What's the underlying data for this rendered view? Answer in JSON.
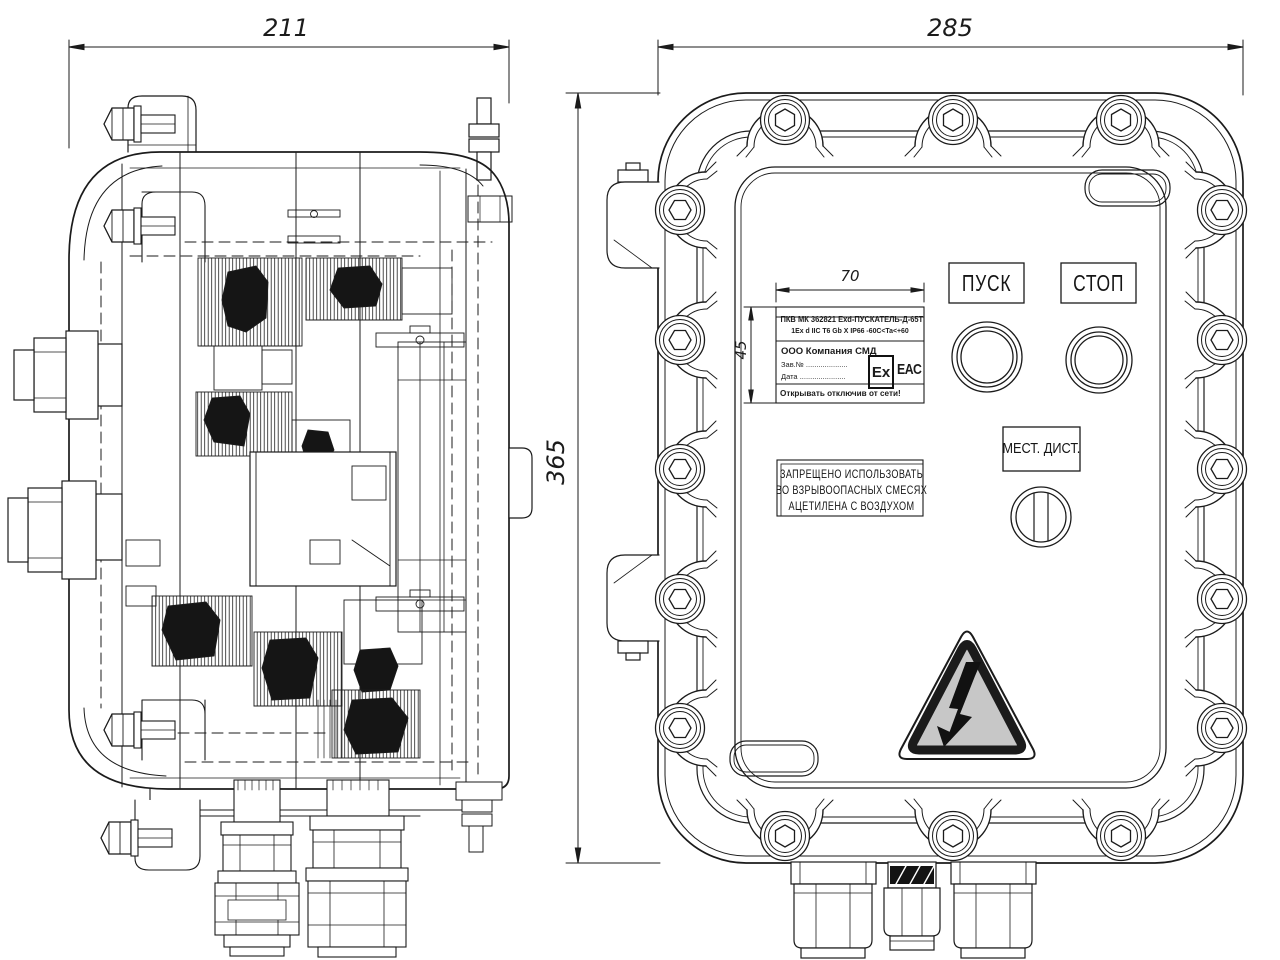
{
  "drawing": {
    "dimensions": {
      "side_view_width": "211",
      "front_view_width": "285",
      "front_view_height": "365",
      "nameplate_width": "70",
      "nameplate_height": "45"
    },
    "nameplate": {
      "line1": "ПКВ МК 362821 Exd-ПУСКАТЕЛЬ-Д-65Т",
      "line2": "1Ex d IIC T6 Gb X   IP66   -60C<Ta<+60",
      "company": "ООО Компания СМД",
      "serial_label": "Зав.№ ....................",
      "date_label": "Дата ......................",
      "ex_mark": "Ex",
      "eac_mark": "ЕАС",
      "open_warning": "Открывать отключив от сети!"
    },
    "controls": {
      "start_label": "ПУСК",
      "stop_label": "СТОП",
      "selector_label": "МЕСТ. ДИСТ."
    },
    "warning_plate": {
      "line1": "ЗАПРЕЩЕНО ИСПОЛЬЗОВАТЬ",
      "line2": "ВО ВЗРЫВООПАСНЫХ СМЕСЯХ",
      "line3": "АЦЕТИЛЕНА С ВОЗДУХОМ"
    },
    "icons": {
      "hazard": "high-voltage-triangle-icon"
    },
    "colors": {
      "line": "#1b1b1b",
      "triangle_fill": "#c7c7c7",
      "gland_band_fill": "#131313",
      "background": "#ffffff"
    }
  }
}
